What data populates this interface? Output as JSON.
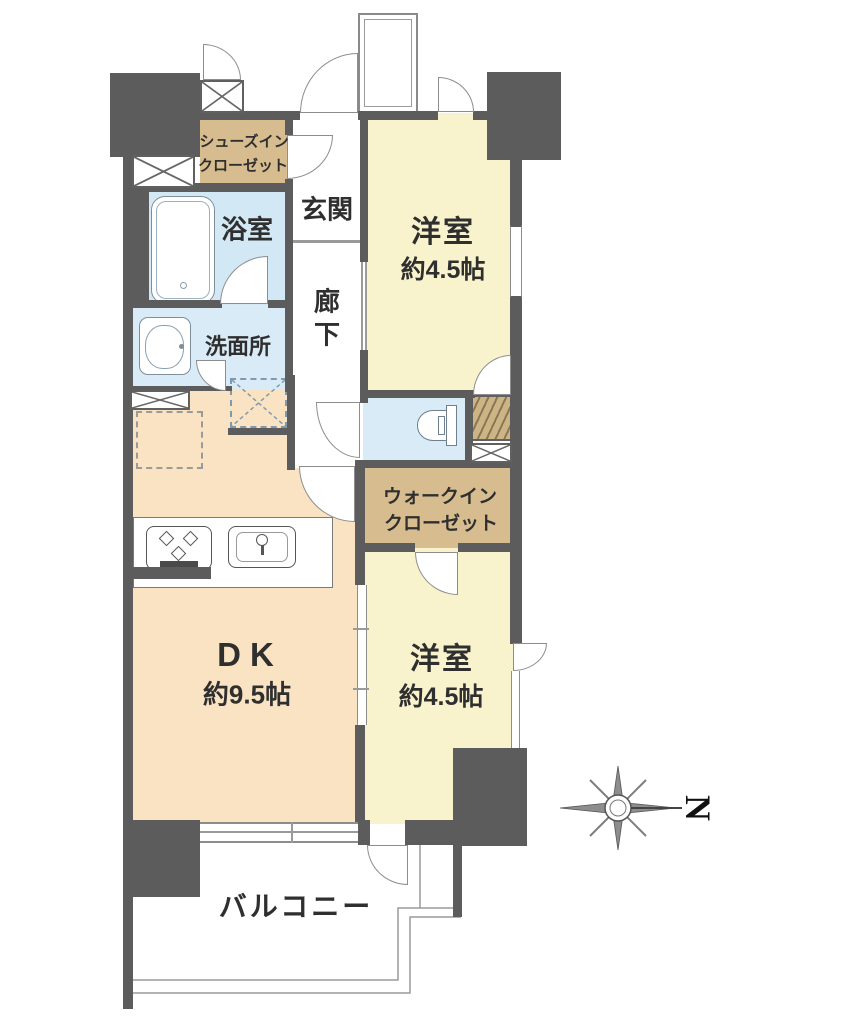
{
  "meta": {
    "type": "apartment-floor-plan"
  },
  "colors": {
    "wall": "#5c5c5c",
    "room_cream": "#f9f3cd",
    "room_peach": "#fae3c2",
    "room_blue": "#d8ebf7",
    "closet_tan": "#d6bc8e",
    "mb_tan": "#cdb485",
    "line": "#8d8d8d",
    "text": "#2f2f2f"
  },
  "rooms": {
    "shoes_closet": {
      "line1": "シューズイン",
      "line2": "クローゼット"
    },
    "bathroom": {
      "label": "浴室"
    },
    "entrance": {
      "label": "玄関"
    },
    "hallway": {
      "char1": "廊",
      "char2": "下"
    },
    "washroom": {
      "label": "洗面所"
    },
    "western_room_1": {
      "label": "洋室",
      "size": "約4.5帖"
    },
    "walk_in_closet": {
      "line1": "ウォークイン",
      "line2": "クローゼット"
    },
    "dk": {
      "label": "DK",
      "size": "約9.5帖"
    },
    "western_room_2": {
      "label": "洋室",
      "size": "約4.5帖"
    },
    "balcony": {
      "label": "バルコニー"
    }
  },
  "compass": {
    "label": "N"
  }
}
